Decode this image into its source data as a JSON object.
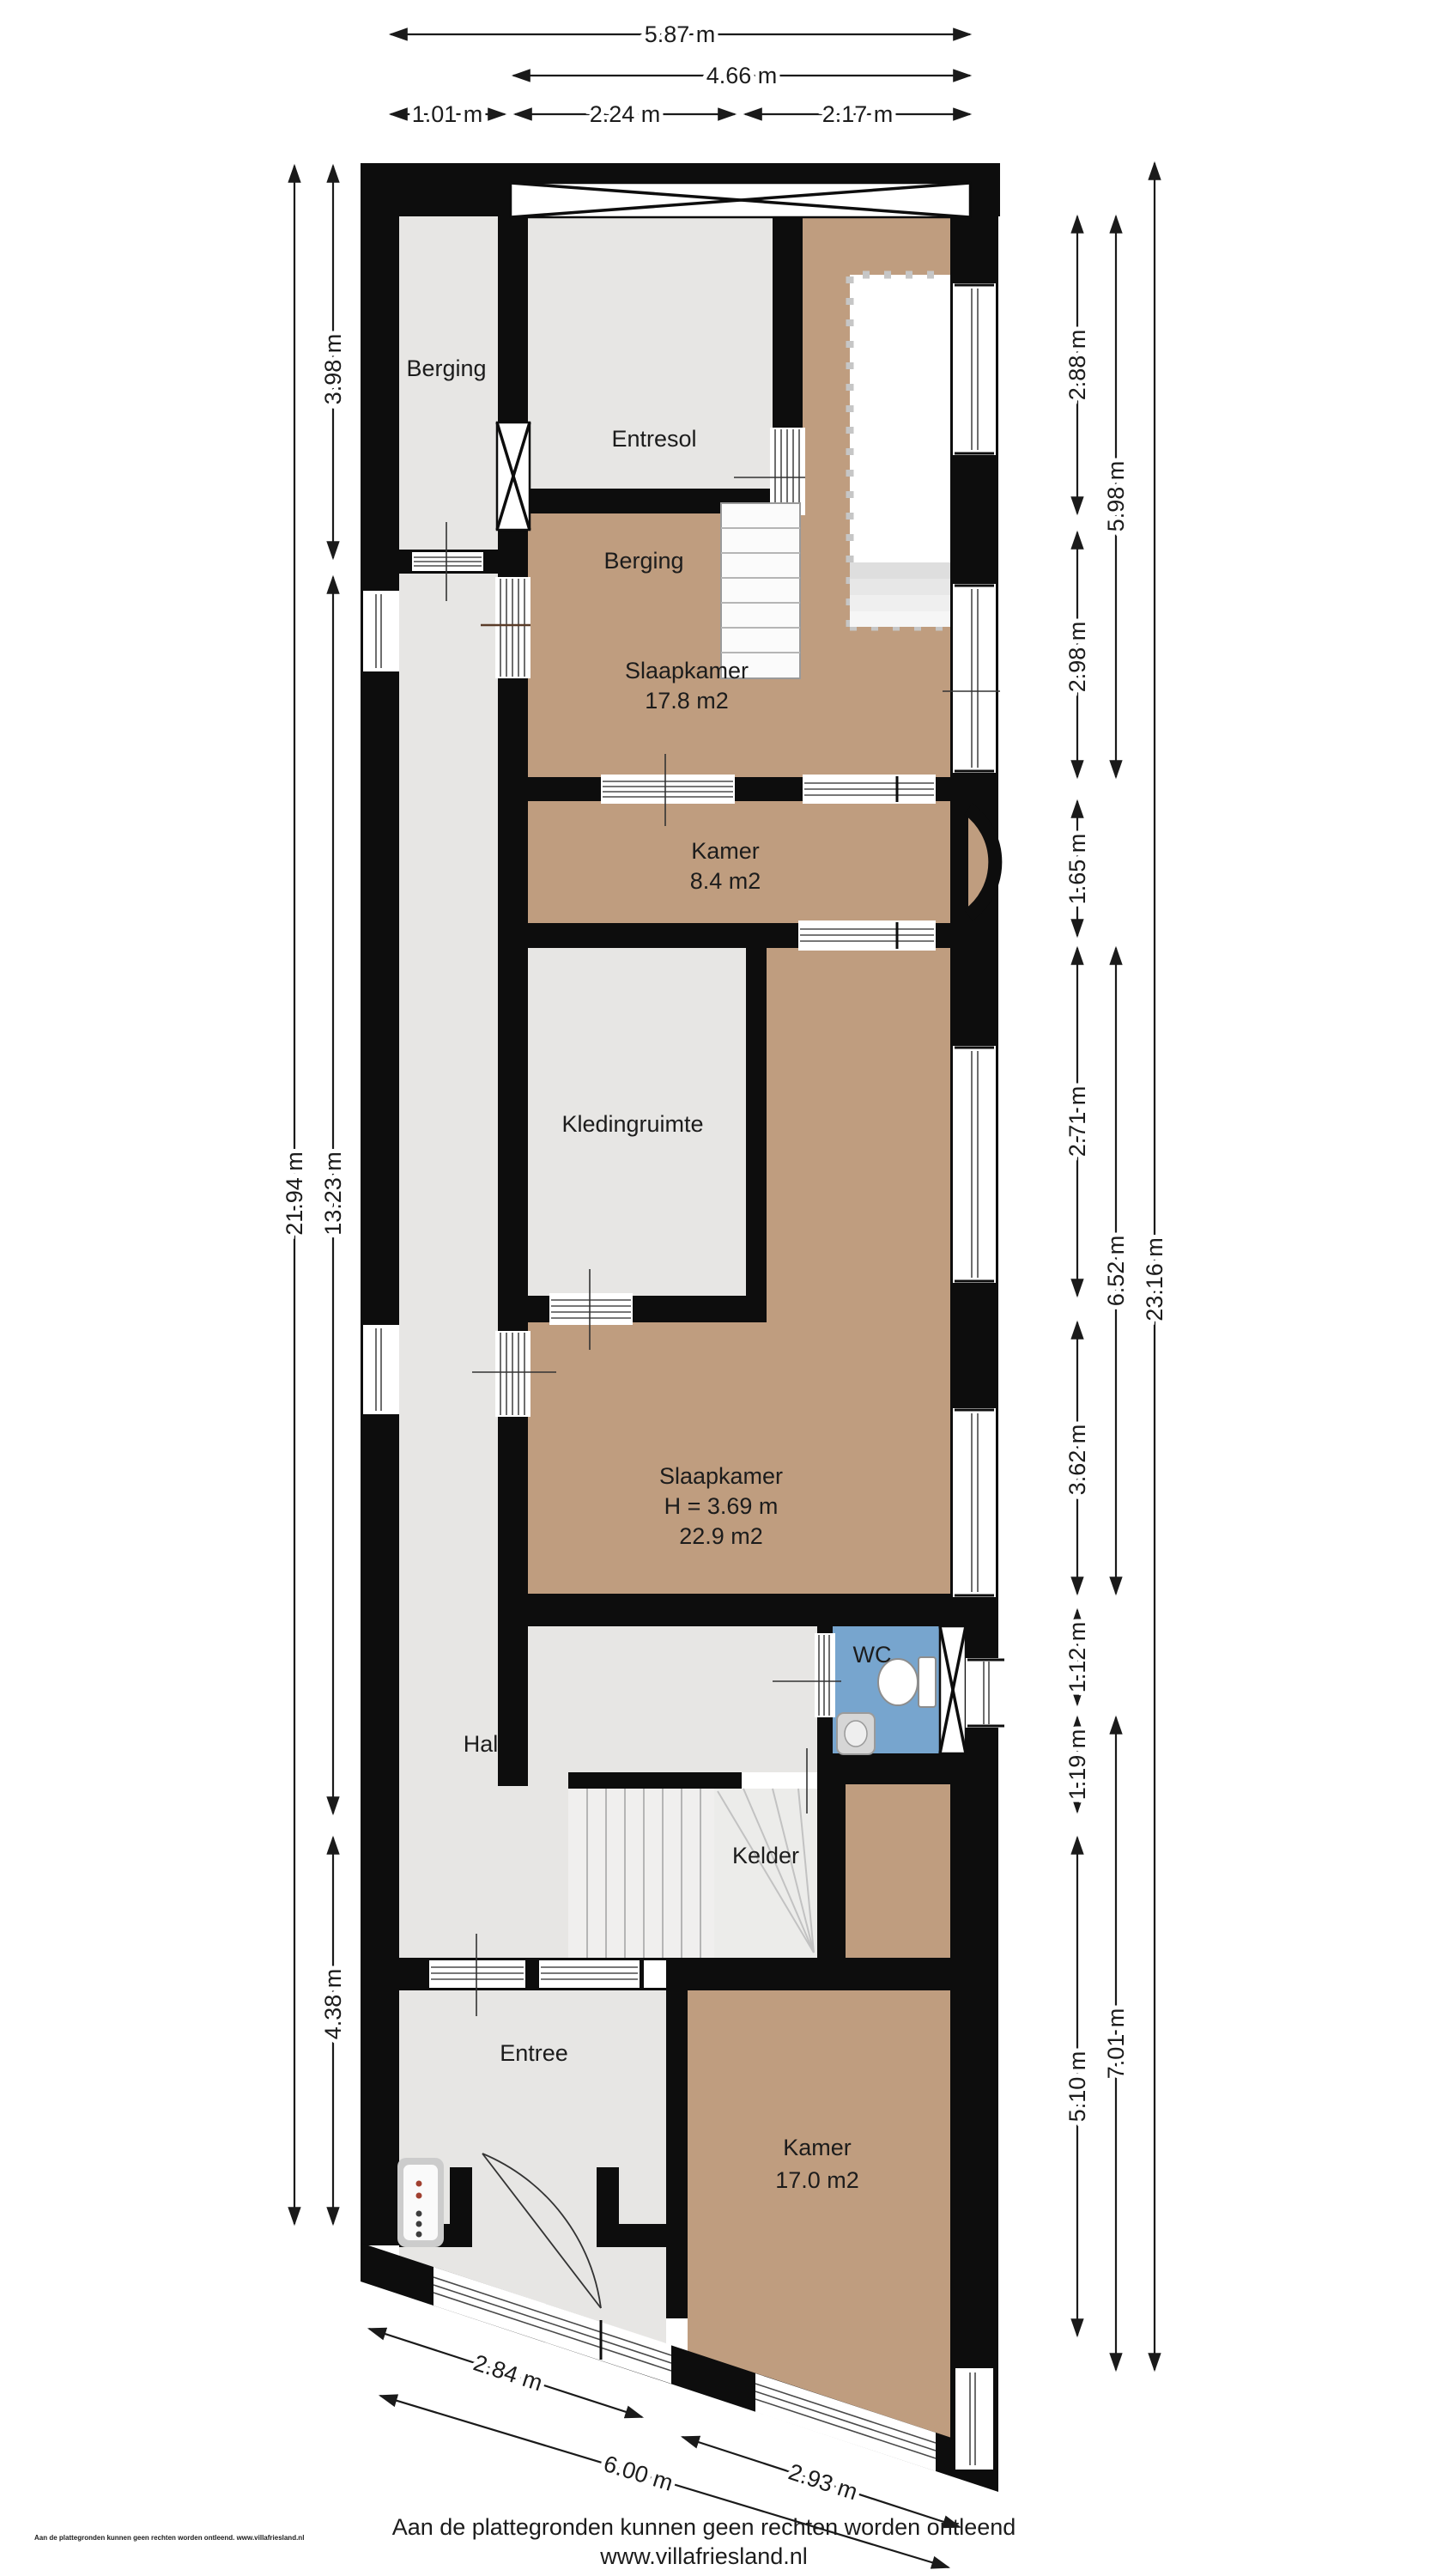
{
  "title": "Floor plan - Villa Friesland",
  "rooms": [
    {
      "id": "berging-strip",
      "label": "Berging"
    },
    {
      "id": "entresol",
      "label": "Entresol"
    },
    {
      "id": "berging",
      "label": "Berging"
    },
    {
      "id": "slaapkamer-1",
      "label": "Slaapkamer",
      "area": "17.8 m2"
    },
    {
      "id": "kamer-1",
      "label": "Kamer",
      "area": "8.4 m2"
    },
    {
      "id": "kledingruimte",
      "label": "Kledingruimte"
    },
    {
      "id": "slaapkamer-2",
      "label": "Slaapkamer",
      "height": "H = 3.69 m",
      "area": "22.9 m2"
    },
    {
      "id": "wc",
      "label": "WC"
    },
    {
      "id": "hal",
      "label": "Hal"
    },
    {
      "id": "kelder",
      "label": "Kelder"
    },
    {
      "id": "entree",
      "label": "Entree"
    },
    {
      "id": "kamer-2",
      "label": "Kamer",
      "area": "17.0 m2"
    }
  ],
  "dimensions": {
    "top": [
      {
        "label": "5.87 m"
      },
      {
        "label": "4.66 m"
      },
      {
        "label": "1.01 m"
      },
      {
        "label": "2.24 m"
      },
      {
        "label": "2.17 m"
      }
    ],
    "left": [
      {
        "label": "21.94 m"
      },
      {
        "label": "3.98 m"
      },
      {
        "label": "13.23 m"
      },
      {
        "label": "4.38 m"
      }
    ],
    "right": [
      {
        "label": "2.88 m"
      },
      {
        "label": "2.98 m"
      },
      {
        "label": "1.65 m"
      },
      {
        "label": "2.71 m"
      },
      {
        "label": "3.62 m"
      },
      {
        "label": "1.12 m"
      },
      {
        "label": "1.19 m"
      },
      {
        "label": "5.10 m"
      },
      {
        "label": "5.98 m"
      },
      {
        "label": "6.52 m"
      },
      {
        "label": "7.01 m"
      },
      {
        "label": "23.16 m"
      }
    ],
    "bottom": [
      {
        "label": "2.84 m"
      },
      {
        "label": "2.93 m"
      },
      {
        "label": "6.00 m"
      }
    ]
  },
  "footer": {
    "disclaimer": "Aan de plattegronden kunnen geen rechten worden ontleend",
    "website": "www.villafriesland.nl",
    "small_print": "Aan de plattegronden kunnen geen rechten worden ontleend. www.villafriesland.nl"
  },
  "colors": {
    "wall": "#0d0d0d",
    "floor_tan": "#bf9d7f",
    "floor_gray": "#e7e6e4",
    "wc_blue": "#77a5ce",
    "background": "#ffffff"
  }
}
